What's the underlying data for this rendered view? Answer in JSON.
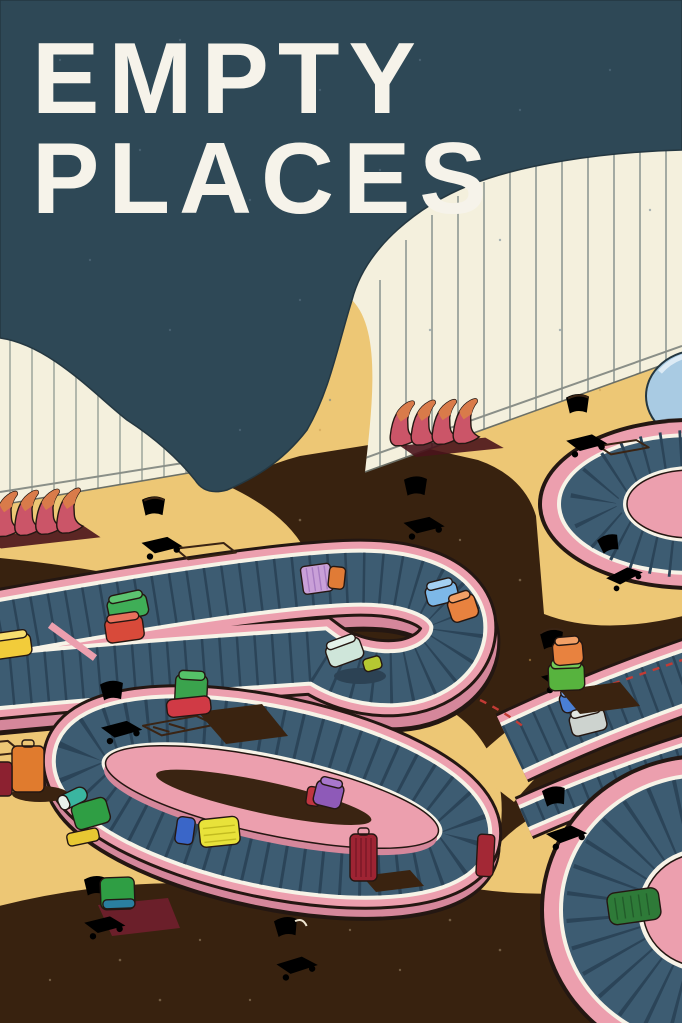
{
  "title": {
    "line1": "EMPTY",
    "line2": "PLACES"
  },
  "palette": {
    "ceiling_teal": "#2e4856",
    "wall_cream": "#f4f0dd",
    "floor_tan": "#edc775",
    "floor_shadow_dark": "#38220f",
    "carousel_pink": "#ec9fae",
    "carousel_pink_shade": "#d5879b",
    "belt_slate": "#3d5c72",
    "belt_slat": "#2b4458",
    "edge_white": "#f7f3e7",
    "outline_dark": "#241712",
    "bench_pink": "#cb5568",
    "bench_orange": "#d97b4a",
    "dome_blue": "#a9cbe3",
    "title_white": "#f6f3ea"
  },
  "scene": {
    "setting": "empty airport baggage-claim hall, isometric illustration",
    "elements": [
      {
        "name": "title-poster-text",
        "text": "EMPTY PLACES"
      },
      {
        "name": "window-wall-left",
        "style": "cream wall with vertical mullions"
      },
      {
        "name": "window-wall-right",
        "style": "cream arched wall with vertical mullions"
      },
      {
        "name": "ceiling-canopy",
        "color": "#2e4856"
      },
      {
        "name": "baggage-carousel-hairpin",
        "color": "#ec9fae"
      },
      {
        "name": "baggage-carousel-oval",
        "color": "#ec9fae"
      },
      {
        "name": "baggage-carousel-top-right",
        "color": "#ec9fae"
      },
      {
        "name": "baggage-carousel-bottom-right",
        "color": "#ec9fae"
      },
      {
        "name": "bench-row-left",
        "seats": 4,
        "color": "#cb5568"
      },
      {
        "name": "bench-row-middle",
        "seats": 4,
        "color": "#cb5568"
      },
      {
        "name": "luggage-carts",
        "count": 9,
        "style": "wireframe outline"
      },
      {
        "name": "suitcases",
        "count": 23,
        "colors": [
          "green",
          "red",
          "orange",
          "yellow",
          "light-blue",
          "mint",
          "purple-striped",
          "dark-red",
          "blue",
          "silver",
          "lime",
          "teal"
        ]
      },
      {
        "name": "blue-dome",
        "color": "#a9cbe3"
      }
    ]
  }
}
